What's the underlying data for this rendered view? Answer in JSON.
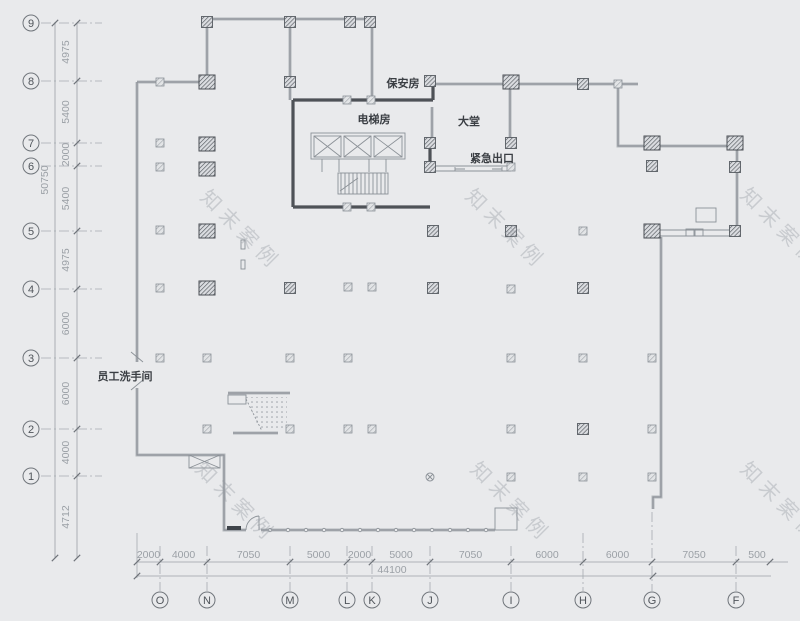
{
  "left_axis": {
    "bubbles": [
      "9",
      "8",
      "7",
      "6",
      "5",
      "4",
      "3",
      "2",
      "1"
    ],
    "dims": [
      "4975",
      "5400",
      "2000",
      "5400",
      "4975",
      "6000",
      "6000",
      "4000",
      "4712"
    ],
    "total": "50750"
  },
  "bottom_axis": {
    "bubbles": [
      "O",
      "N",
      "M",
      "L",
      "K",
      "J",
      "I",
      "H",
      "G",
      "F"
    ],
    "dims": [
      "2000",
      "4000",
      "7050",
      "5000",
      "2000",
      "5000",
      "7050",
      "6000",
      "6000",
      "7050",
      "500"
    ],
    "total": "44100"
  },
  "rooms": {
    "security": "保安房",
    "elevator": "电梯房",
    "lobby": "大堂",
    "emergency_exit": "紧急出口",
    "staff_restroom": "员工洗手间"
  },
  "watermark": "知末案例",
  "colors": {
    "background": "#e9eaec",
    "wall_light": "#b4b8bd",
    "wall_dark": "#4e5257",
    "dim_text": "#9ba0a6",
    "label_text": "#3a3e43",
    "watermark": "#9499a0"
  }
}
